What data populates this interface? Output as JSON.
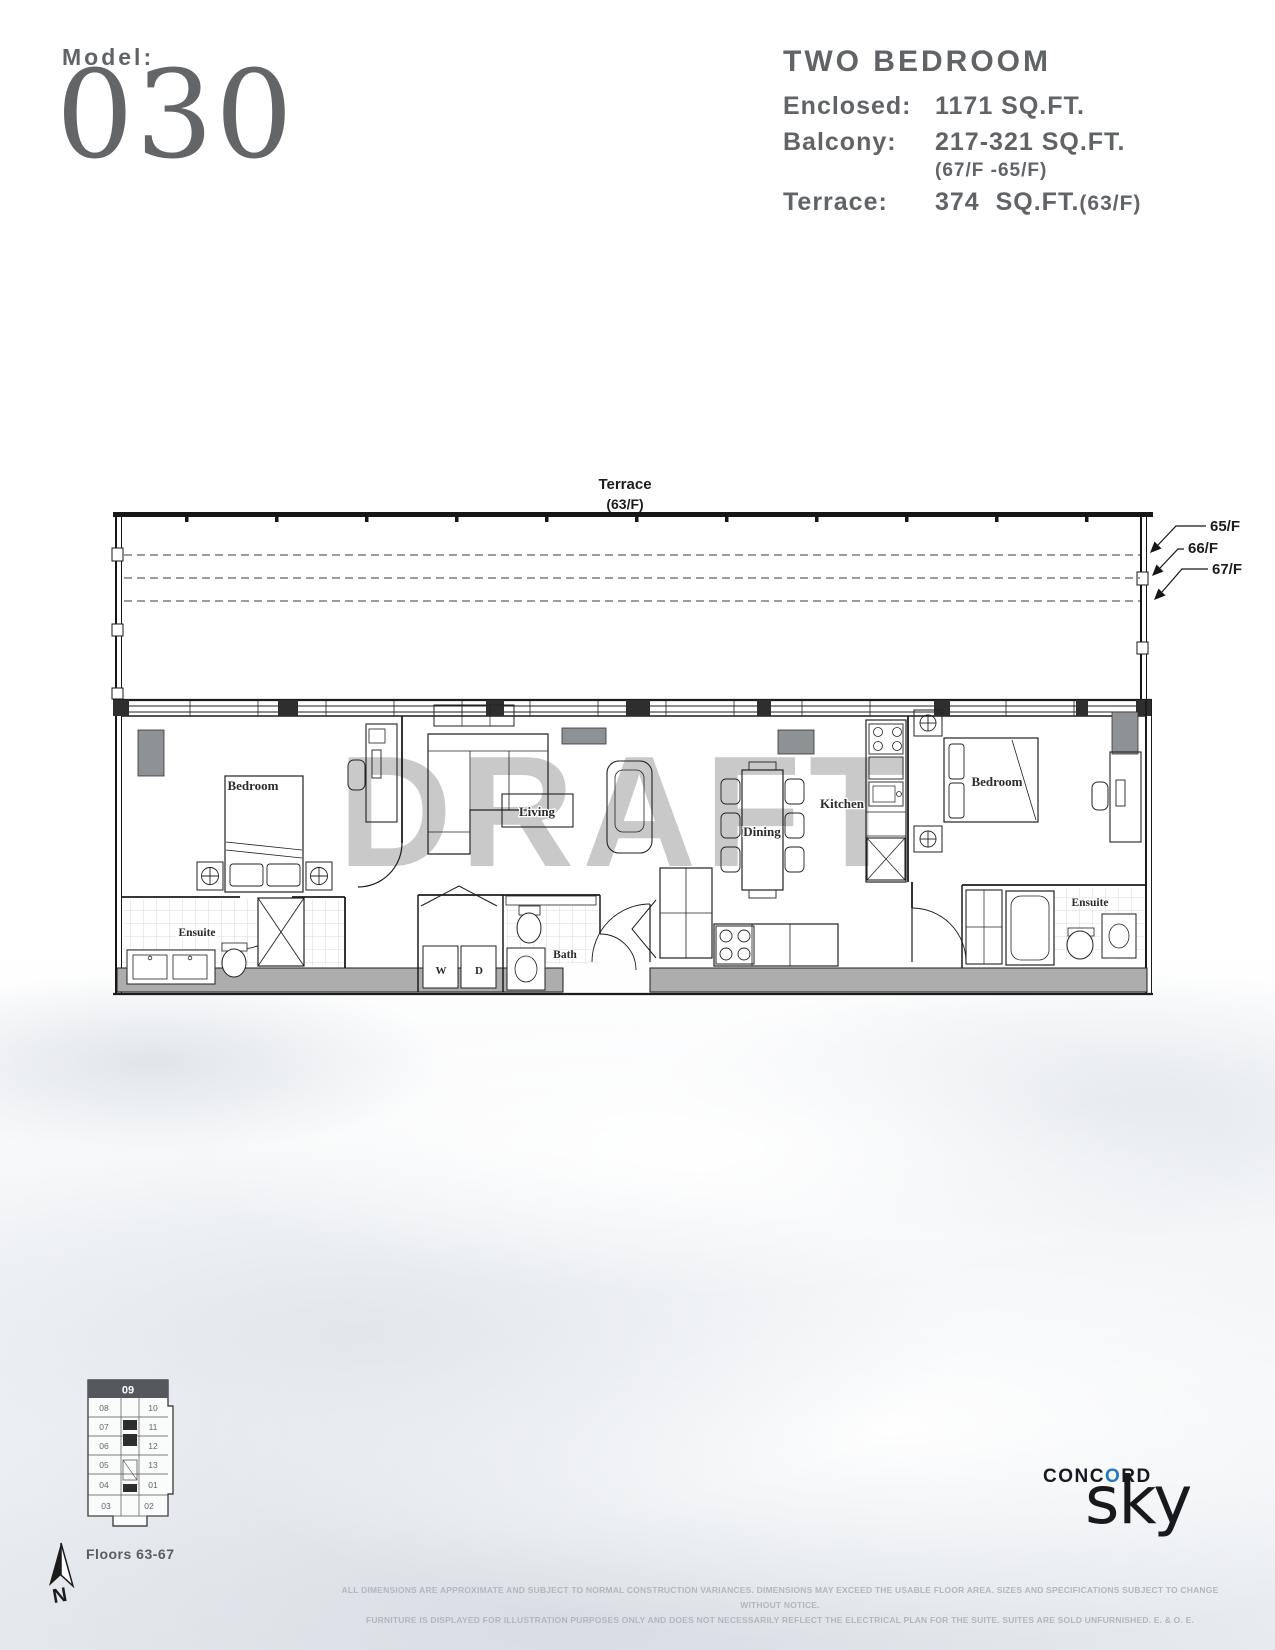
{
  "header": {
    "model_label": "Model:",
    "model_number": "030",
    "unit_type": "TWO BEDROOM",
    "specs": {
      "enclosed_label": "Enclosed:",
      "enclosed_value": "1171 SQ.FT.",
      "balcony_label": "Balcony:",
      "balcony_value": "217-321 SQ.FT.",
      "balcony_note": "(67/F -65/F)",
      "terrace_label": "Terrace:",
      "terrace_value": "374  SQ.FT.",
      "terrace_note": "(63/F)"
    }
  },
  "plan": {
    "terrace_label": "Terrace",
    "terrace_floor": "(63/F)",
    "watermark": "DRAFT",
    "levels": [
      "65/F",
      "66/F",
      "67/F"
    ],
    "rooms": {
      "bedroom_left": "Bedroom",
      "ensuite_left": "Ensuite",
      "living": "Living",
      "dining": "Dining",
      "kitchen": "Kitchen",
      "bath": "Bath",
      "washer": "W",
      "dryer": "D",
      "bedroom_right": "Bedroom",
      "ensuite_right": "Ensuite"
    }
  },
  "keyplan": {
    "highlight_unit": "09",
    "left_units": [
      "08",
      "07",
      "06",
      "05",
      "04",
      "03"
    ],
    "right_units": [
      "10",
      "11",
      "12",
      "13",
      "01",
      "02"
    ],
    "floors_label": "Floors 63-67",
    "north_label": "N"
  },
  "branding": {
    "concord_pre": "CONC",
    "concord_o": "O",
    "concord_post": "RD",
    "wordmark": "sky"
  },
  "disclaimer": {
    "line1": "ALL DIMENSIONS ARE APPROXIMATE AND SUBJECT TO NORMAL CONSTRUCTION VARIANCES. DIMENSIONS MAY EXCEED THE USABLE FLOOR AREA. SIZES AND SPECIFICATIONS SUBJECT TO CHANGE WITHOUT NOTICE.",
    "line2": "FURNITURE IS DISPLAYED FOR ILLUSTRATION PURPOSES ONLY AND DOES NOT NECESSARILY REFLECT THE ELECTRICAL PLAN FOR THE SUITE. SUITES ARE SOLD UNFURNISHED. E. & O. E."
  },
  "icons": {
    "north_arrow": "compass-needle",
    "level_arrow": "diagonal-arrow",
    "lamp_symbol": "circle-cross"
  },
  "colors": {
    "accent_blue": "#2478bd",
    "header_text": "#616467",
    "logo_text": "#141922",
    "keyplan_header": "#54585c",
    "watermark_gray": "#c9c9c9",
    "line_dark": "#1c1c1c",
    "wall_fill": "#adadad",
    "block_gray": "#8f9294",
    "disclaimer_text": "#b0b7be"
  }
}
